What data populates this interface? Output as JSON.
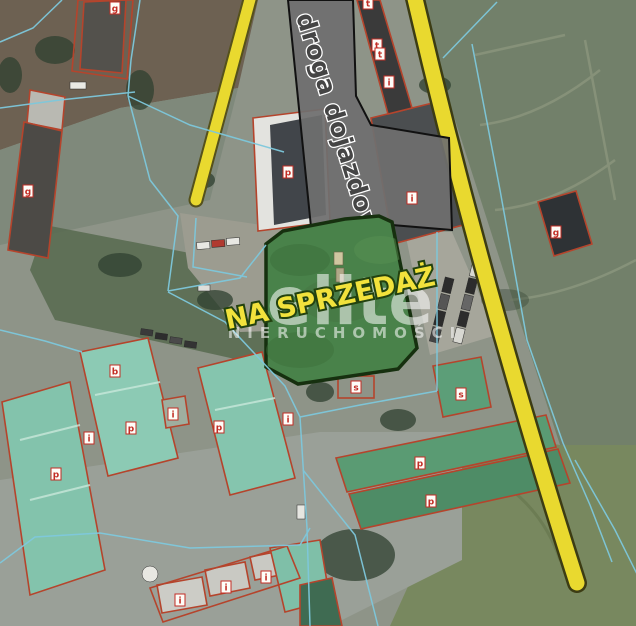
{
  "map": {
    "type": "aerial-cadastral-listing",
    "listing_label": "NA SPRZEDAŻ",
    "access_road_label": "droga dojazdowa",
    "watermark": {
      "brand": "elite",
      "subtitle": "NIERUCHOMOŚCI"
    },
    "colors": {
      "road_yellow": "#e9d92f",
      "road_outline": "#55511c",
      "plot_green": "#49824a",
      "plot_border": "#16300f",
      "sale_text_yellow": "#f2e23c",
      "sale_text_outline": "#23420f",
      "access_road_fill": "#6f6f6f",
      "access_road_text": "#454545",
      "cadastral_blue": "#7ec8dc",
      "building_outline_red": "#b5442c",
      "label_red": "#c22d25",
      "teal_roof": "#85c5ae",
      "green_roof": "#5a9b73",
      "farmland": "#72806a"
    },
    "building_labels": [
      {
        "letter": "g",
        "x": 115,
        "y": 8
      },
      {
        "letter": "g",
        "x": 28,
        "y": 191
      },
      {
        "letter": "p",
        "x": 288,
        "y": 172
      },
      {
        "letter": "t",
        "x": 368,
        "y": 3
      },
      {
        "letter": "t",
        "x": 377,
        "y": 45
      },
      {
        "letter": "t",
        "x": 380,
        "y": 54
      },
      {
        "letter": "i",
        "x": 389,
        "y": 82
      },
      {
        "letter": "i",
        "x": 412,
        "y": 198
      },
      {
        "letter": "g",
        "x": 556,
        "y": 232
      },
      {
        "letter": "s",
        "x": 356,
        "y": 387
      },
      {
        "letter": "i",
        "x": 288,
        "y": 419
      },
      {
        "letter": "b",
        "x": 115,
        "y": 371
      },
      {
        "letter": "p",
        "x": 131,
        "y": 428
      },
      {
        "letter": "i",
        "x": 89,
        "y": 438
      },
      {
        "letter": "i",
        "x": 173,
        "y": 414
      },
      {
        "letter": "p",
        "x": 56,
        "y": 474
      },
      {
        "letter": "p",
        "x": 219,
        "y": 427
      },
      {
        "letter": "s",
        "x": 461,
        "y": 394
      },
      {
        "letter": "p",
        "x": 420,
        "y": 463
      },
      {
        "letter": "p",
        "x": 431,
        "y": 501
      },
      {
        "letter": "i",
        "x": 180,
        "y": 600
      },
      {
        "letter": "i",
        "x": 226,
        "y": 587
      },
      {
        "letter": "i",
        "x": 266,
        "y": 577
      }
    ]
  }
}
